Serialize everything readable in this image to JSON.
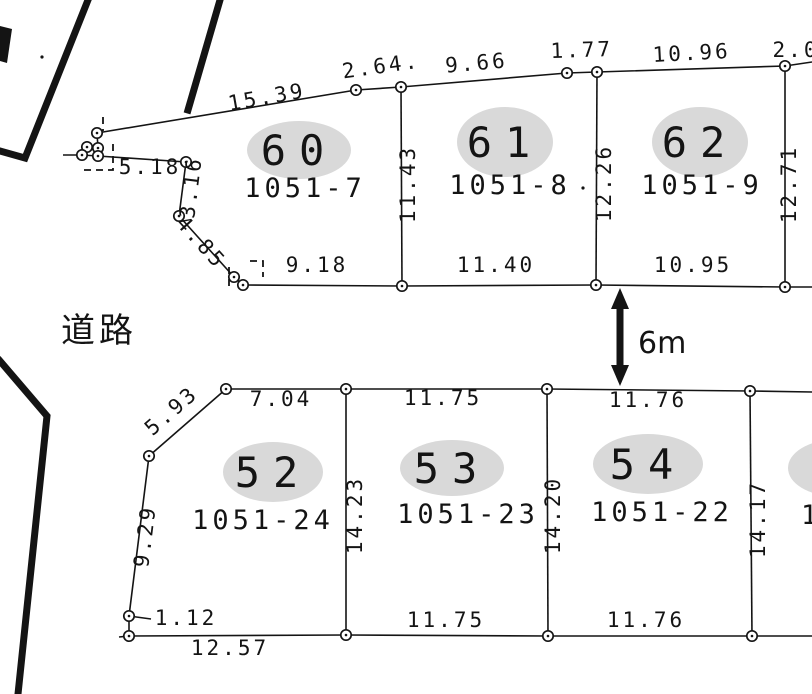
{
  "canvas": {
    "width": 812,
    "height": 694,
    "background": "#ffffff",
    "ink": "#141414",
    "ellipse_fill": "#d9d9d9"
  },
  "road": {
    "label": "道路"
  },
  "road_width": {
    "label": "6m",
    "arrow": {
      "x": 620,
      "y1": 288,
      "y2": 386
    }
  },
  "plots": [
    {
      "number": "60",
      "parcel": "1051-7",
      "ellipse": {
        "cx": 299,
        "cy": 150,
        "rx": 52,
        "ry": 29
      },
      "number_pos": [
        299,
        165
      ],
      "parcel_pos": [
        305,
        197
      ]
    },
    {
      "number": "61",
      "parcel": "1051-8",
      "ellipse": {
        "cx": 505,
        "cy": 142,
        "rx": 48,
        "ry": 35
      },
      "number_pos": [
        505,
        157
      ],
      "parcel_pos": [
        510,
        194
      ]
    },
    {
      "number": "62",
      "parcel": "1051-9",
      "ellipse": {
        "cx": 700,
        "cy": 142,
        "rx": 48,
        "ry": 35
      },
      "number_pos": [
        700,
        157
      ],
      "parcel_pos": [
        702,
        194
      ]
    },
    {
      "number": "52",
      "parcel": "1051-24",
      "ellipse": {
        "cx": 273,
        "cy": 472,
        "rx": 50,
        "ry": 30
      },
      "number_pos": [
        273,
        487
      ],
      "parcel_pos": [
        263,
        529
      ]
    },
    {
      "number": "53",
      "parcel": "1051-23",
      "ellipse": {
        "cx": 452,
        "cy": 468,
        "rx": 52,
        "ry": 28
      },
      "number_pos": [
        452,
        483
      ],
      "parcel_pos": [
        468,
        523
      ]
    },
    {
      "number": "54",
      "parcel": "1051-22",
      "ellipse": {
        "cx": 648,
        "cy": 464,
        "rx": 55,
        "ry": 30
      },
      "number_pos": [
        648,
        479
      ],
      "parcel_pos": [
        662,
        521
      ]
    }
  ],
  "clipped_plot": {
    "ellipse": {
      "cx": 834,
      "cy": 468,
      "rx": 46,
      "ry": 28
    },
    "parcel_fragment": "1",
    "parcel_pos": [
      801,
      524
    ],
    "top_dimension_fragment": "2.0",
    "top_dimension_pos": [
      796,
      57
    ]
  },
  "dimensions": [
    {
      "text": "15.39",
      "x": 268,
      "y": 104,
      "rot": -10
    },
    {
      "text": "2.64.",
      "x": 382,
      "y": 73,
      "rot": -8
    },
    {
      "text": "9.66",
      "x": 477,
      "y": 70,
      "rot": -5
    },
    {
      "text": "1.77",
      "x": 582,
      "y": 57,
      "rot": -2
    },
    {
      "text": "10.96",
      "x": 692,
      "y": 60,
      "rot": -3
    },
    {
      "text": "5.18",
      "x": 150,
      "y": 174,
      "rot": 0
    },
    {
      "text": "3.16",
      "x": 198,
      "y": 188,
      "rot": -83
    },
    {
      "text": "4.85",
      "x": 196,
      "y": 247,
      "rot": 48
    },
    {
      "text": "9.18",
      "x": 317,
      "y": 272,
      "rot": 0
    },
    {
      "text": "11.40",
      "x": 496,
      "y": 272,
      "rot": 0
    },
    {
      "text": "10.95",
      "x": 693,
      "y": 272,
      "rot": 0
    },
    {
      "text": "11.43",
      "x": 415,
      "y": 184,
      "rot": -90
    },
    {
      "text": "12.26",
      "x": 611,
      "y": 183,
      "rot": -90
    },
    {
      "text": "12.71",
      "x": 796,
      "y": 184,
      "rot": -90
    },
    {
      "text": "5.93",
      "x": 176,
      "y": 416,
      "rot": -41
    },
    {
      "text": "7.04",
      "x": 281,
      "y": 406,
      "rot": 0
    },
    {
      "text": "11.75",
      "x": 443,
      "y": 405,
      "rot": 0
    },
    {
      "text": "11.76",
      "x": 648,
      "y": 407,
      "rot": 0
    },
    {
      "text": "14.23",
      "x": 362,
      "y": 515,
      "rot": -90
    },
    {
      "text": "14.20",
      "x": 560,
      "y": 515,
      "rot": -90
    },
    {
      "text": "14.17",
      "x": 765,
      "y": 519,
      "rot": -90
    },
    {
      "text": "9.29",
      "x": 152,
      "y": 537,
      "rot": -83
    },
    {
      "text": "1.12",
      "x": 186,
      "y": 625,
      "rot": 0
    },
    {
      "text": "12.57",
      "x": 230,
      "y": 655,
      "rot": 0
    },
    {
      "text": "11.75",
      "x": 446,
      "y": 627,
      "rot": 0
    },
    {
      "text": "11.76",
      "x": 646,
      "y": 627,
      "rot": 0
    }
  ],
  "boundary_lines": [
    [
      [
        97,
        133
      ],
      [
        356,
        90
      ],
      [
        401,
        87
      ],
      [
        567,
        73
      ],
      [
        597,
        72
      ],
      [
        785,
        66
      ],
      [
        812,
        62
      ]
    ],
    [
      [
        243,
        285
      ],
      [
        402,
        286
      ],
      [
        596,
        285
      ],
      [
        785,
        287
      ],
      [
        812,
        287
      ]
    ],
    [
      [
        98,
        156
      ],
      [
        186,
        162
      ]
    ],
    [
      [
        186,
        162
      ],
      [
        179,
        216
      ]
    ],
    [
      [
        179,
        216
      ],
      [
        234,
        277
      ]
    ],
    [
      [
        234,
        277
      ],
      [
        243,
        285
      ]
    ],
    [
      [
        63,
        155
      ],
      [
        82,
        155
      ]
    ],
    [
      [
        97,
        133
      ],
      [
        98,
        148
      ]
    ],
    [
      [
        87,
        147
      ],
      [
        82,
        155
      ]
    ],
    [
      [
        98,
        148
      ],
      [
        98,
        156
      ]
    ],
    [
      [
        82,
        155
      ],
      [
        98,
        156
      ]
    ],
    [
      [
        401,
        87
      ],
      [
        402,
        286
      ]
    ],
    [
      [
        597,
        72
      ],
      [
        596,
        285
      ]
    ],
    [
      [
        785,
        66
      ],
      [
        785,
        287
      ]
    ],
    [
      [
        226,
        389
      ],
      [
        346,
        389
      ],
      [
        547,
        389
      ],
      [
        750,
        391
      ],
      [
        812,
        392
      ]
    ],
    [
      [
        119,
        637
      ],
      [
        129,
        636
      ],
      [
        346,
        635
      ],
      [
        548,
        636
      ],
      [
        752,
        636
      ],
      [
        812,
        636
      ]
    ],
    [
      [
        226,
        389
      ],
      [
        149,
        456
      ]
    ],
    [
      [
        149,
        456
      ],
      [
        129,
        616
      ]
    ],
    [
      [
        129,
        616
      ],
      [
        129,
        636
      ]
    ],
    [
      [
        346,
        389
      ],
      [
        346,
        635
      ]
    ],
    [
      [
        547,
        389
      ],
      [
        548,
        636
      ]
    ],
    [
      [
        750,
        391
      ],
      [
        752,
        636
      ]
    ],
    [
      [
        129,
        616
      ],
      [
        151,
        619
      ]
    ]
  ],
  "dashed_marks": [
    [
      [
        103,
        117
      ],
      [
        103,
        131
      ]
    ],
    [
      [
        84,
        170
      ],
      [
        113,
        170
      ],
      [
        113,
        140
      ]
    ],
    [
      [
        229,
        286
      ],
      [
        229,
        264
      ]
    ],
    [
      [
        250,
        261
      ],
      [
        263,
        261
      ],
      [
        263,
        277
      ]
    ]
  ],
  "road_edge_lines": [
    [
      [
        88,
        0
      ],
      [
        25,
        158
      ],
      [
        0,
        151
      ]
    ],
    [
      [
        220,
        0
      ],
      [
        188,
        110
      ]
    ],
    [
      [
        0,
        361
      ],
      [
        47,
        416
      ],
      [
        18,
        694
      ]
    ]
  ],
  "road_edge_wedge": [
    [
      0,
      26
    ],
    [
      12,
      29
    ],
    [
      7,
      63
    ],
    [
      0,
      61
    ]
  ],
  "vertices": [
    [
      97,
      133
    ],
    [
      87,
      147
    ],
    [
      98,
      148
    ],
    [
      82,
      155
    ],
    [
      98,
      156
    ],
    [
      356,
      90
    ],
    [
      401,
      87
    ],
    [
      567,
      73
    ],
    [
      597,
      72
    ],
    [
      785,
      66
    ],
    [
      402,
      286
    ],
    [
      596,
      285
    ],
    [
      785,
      287
    ],
    [
      243,
      285
    ],
    [
      234,
      277
    ],
    [
      179,
      216
    ],
    [
      186,
      162
    ],
    [
      226,
      389
    ],
    [
      346,
      389
    ],
    [
      547,
      389
    ],
    [
      750,
      391
    ],
    [
      149,
      456
    ],
    [
      129,
      616
    ],
    [
      129,
      636
    ],
    [
      346,
      635
    ],
    [
      548,
      636
    ],
    [
      752,
      636
    ]
  ],
  "specks": [
    [
      42,
      57
    ],
    [
      583,
      188
    ]
  ]
}
